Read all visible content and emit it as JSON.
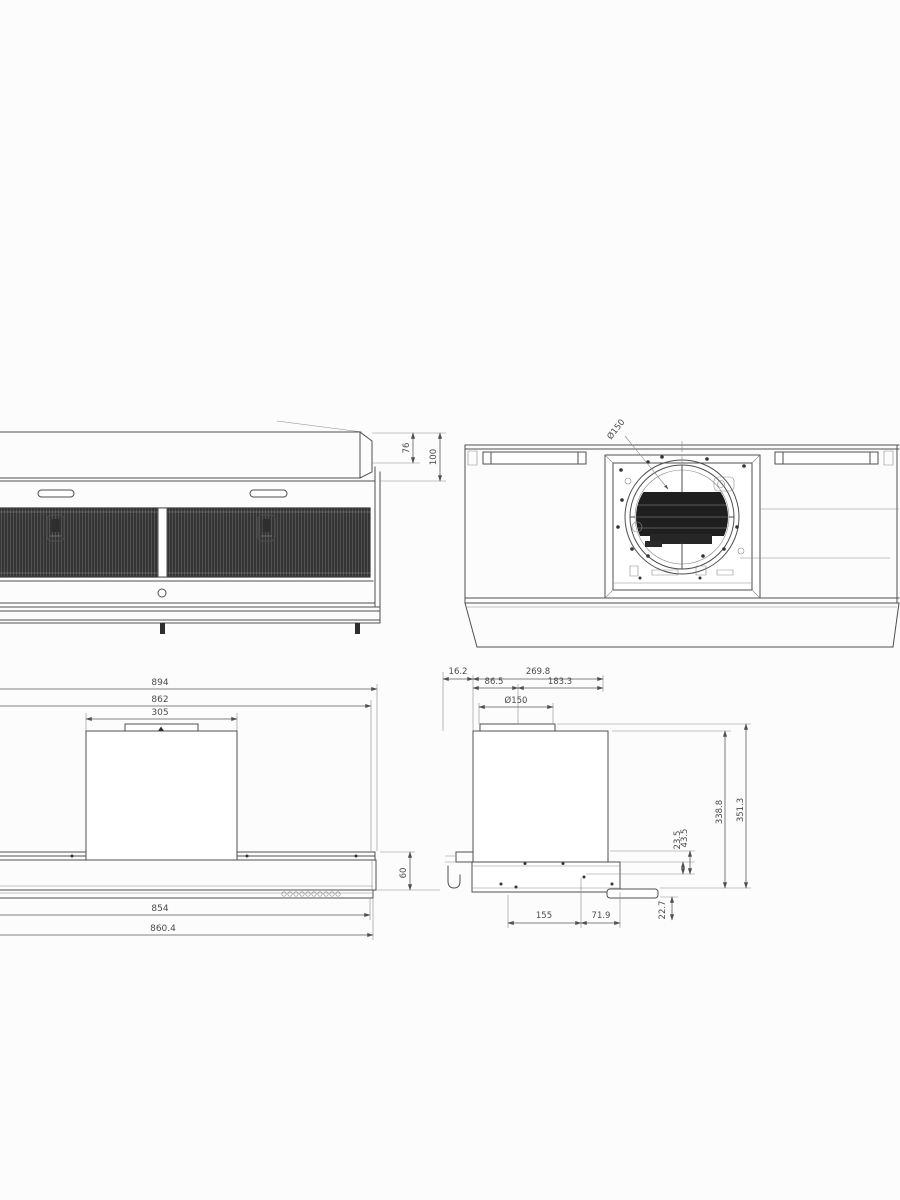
{
  "drawing": {
    "title": "range-hood-dimension-drawing",
    "front_view": {
      "dim_box_height": "76",
      "dim_total_height": "100"
    },
    "top_view": {
      "duct_label": "Ø150"
    },
    "bottom_view": {
      "dim_overall_width": "894",
      "dim_body_width": "862",
      "dim_chimney_width": "305",
      "dim_band_height": "60",
      "dim_inner_width": "854",
      "dim_glass_width": "860.4"
    },
    "side_view": {
      "dim_front_offset": "16.2",
      "dim_depth_total": "269.8",
      "dim_duct_front": "86.5",
      "dim_duct_rear": "183.3",
      "dim_duct_diameter": "Ø150",
      "dim_body_height": "338.8",
      "dim_total_height": "351.3",
      "dim_h1": "23.5",
      "dim_h2": "43.5",
      "dim_h3": "22.7",
      "dim_hole_front": "155",
      "dim_hole_rear": "71.9"
    }
  },
  "colors": {
    "line": "#4f4f4f",
    "dark_fill": "#2e2e2e",
    "background": "#fcfcfc"
  }
}
